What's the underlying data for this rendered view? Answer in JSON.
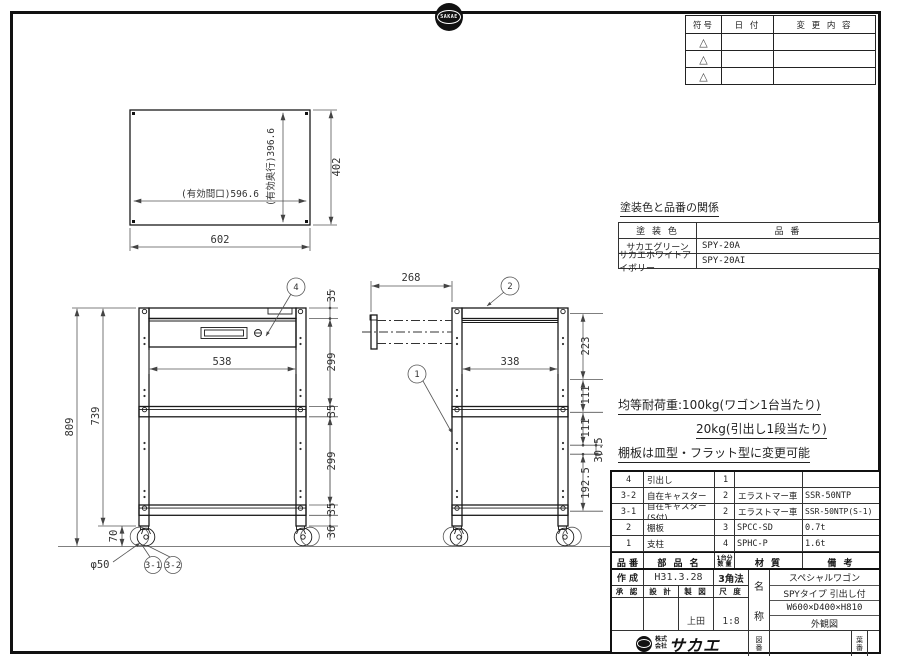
{
  "colors": {
    "line": "#1a1a1a",
    "dimension": "#555555",
    "background": "#ffffff"
  },
  "page": {
    "top_logo_text": "SAKAE",
    "bottom_logo": {
      "company_prefix": "株式会社",
      "company_name": "サカエ"
    }
  },
  "revision_table": {
    "col_symbol": "符号",
    "col_date": "日 付",
    "col_change": "変 更 内 容",
    "triangle_icon": "△"
  },
  "color_table": {
    "title": "塗装色と品番の関係",
    "col_color": "塗 装 色",
    "col_part": "品 番",
    "rows": [
      {
        "color": "サカエグリーン",
        "part": "SPY-20A"
      },
      {
        "color": "サカエホワイトアイボリー",
        "part": "SPY-20AI"
      }
    ]
  },
  "notes": {
    "line1": "均等耐荷重:100kg(ワゴン1台当たり)",
    "line2": "20kg(引出し1段当たり)",
    "line3": "棚板は皿型・フラット型に変更可能",
    "line4": "引出し内寸法:W513×D288×H81"
  },
  "parts_table": {
    "col_no": "品 番",
    "col_name": "部 品 名",
    "col_qty_1": "1台分",
    "col_qty_2": "数 量",
    "col_material": "材 質",
    "col_remarks": "備 考",
    "rows": [
      {
        "no": "4",
        "name": "引出し",
        "qty": "1",
        "material": "",
        "remarks": ""
      },
      {
        "no": "3-2",
        "name": "自在キャスター",
        "qty": "2",
        "material": "エラストマー車",
        "remarks": "SSR-50NTP"
      },
      {
        "no": "3-1",
        "name": "自在キャスター(S付)",
        "qty": "2",
        "material": "エラストマー車",
        "remarks": "SSR-50NTP(S-1)"
      },
      {
        "no": "2",
        "name": "棚板",
        "qty": "3",
        "material": "SPCC-SD",
        "remarks": "0.7t"
      },
      {
        "no": "1",
        "name": "支柱",
        "qty": "4",
        "material": "SPHC-P",
        "remarks": "1.6t"
      }
    ]
  },
  "title_block": {
    "created_label": "作 成",
    "created_date": "H31.3.28",
    "projection": "3角法",
    "approved_label": "承 認",
    "design_label": "設 計",
    "draft_label": "製 図",
    "scale_label": "尺 度",
    "drafter": "上田",
    "scale": "1:8",
    "name_top": "名",
    "name_bottom": "称",
    "product_line1": "スペシャルワゴン",
    "product_line2": "SPYタイプ 引出し付",
    "product_line3": "W600×D400×H810",
    "product_line4": "外観図",
    "drawing_no_label": "図番",
    "sheet_no_label": "葉番"
  },
  "drawing": {
    "top_view": {
      "width": "602",
      "depth": "402",
      "effective_width": "(有効間口)596.6",
      "effective_depth": "(有効奥行)396.6"
    },
    "front_view": {
      "overall_height": "809",
      "post_height": "739",
      "caster_height": "70",
      "inner_width": "538",
      "dim_35": "35",
      "dim_299": "299",
      "dim_36": "36",
      "caster_dia": "φ50"
    },
    "side_view": {
      "drawer_extension": "268",
      "inner_depth": "338",
      "dim_223": "223",
      "dim_111": "111",
      "dim_30_5": "30.5",
      "dim_192_5": "192.5"
    },
    "balloons": {
      "b1": "1",
      "b2": "2",
      "b4": "4",
      "b3_1": "3-1",
      "b3_2": "3-2"
    }
  }
}
